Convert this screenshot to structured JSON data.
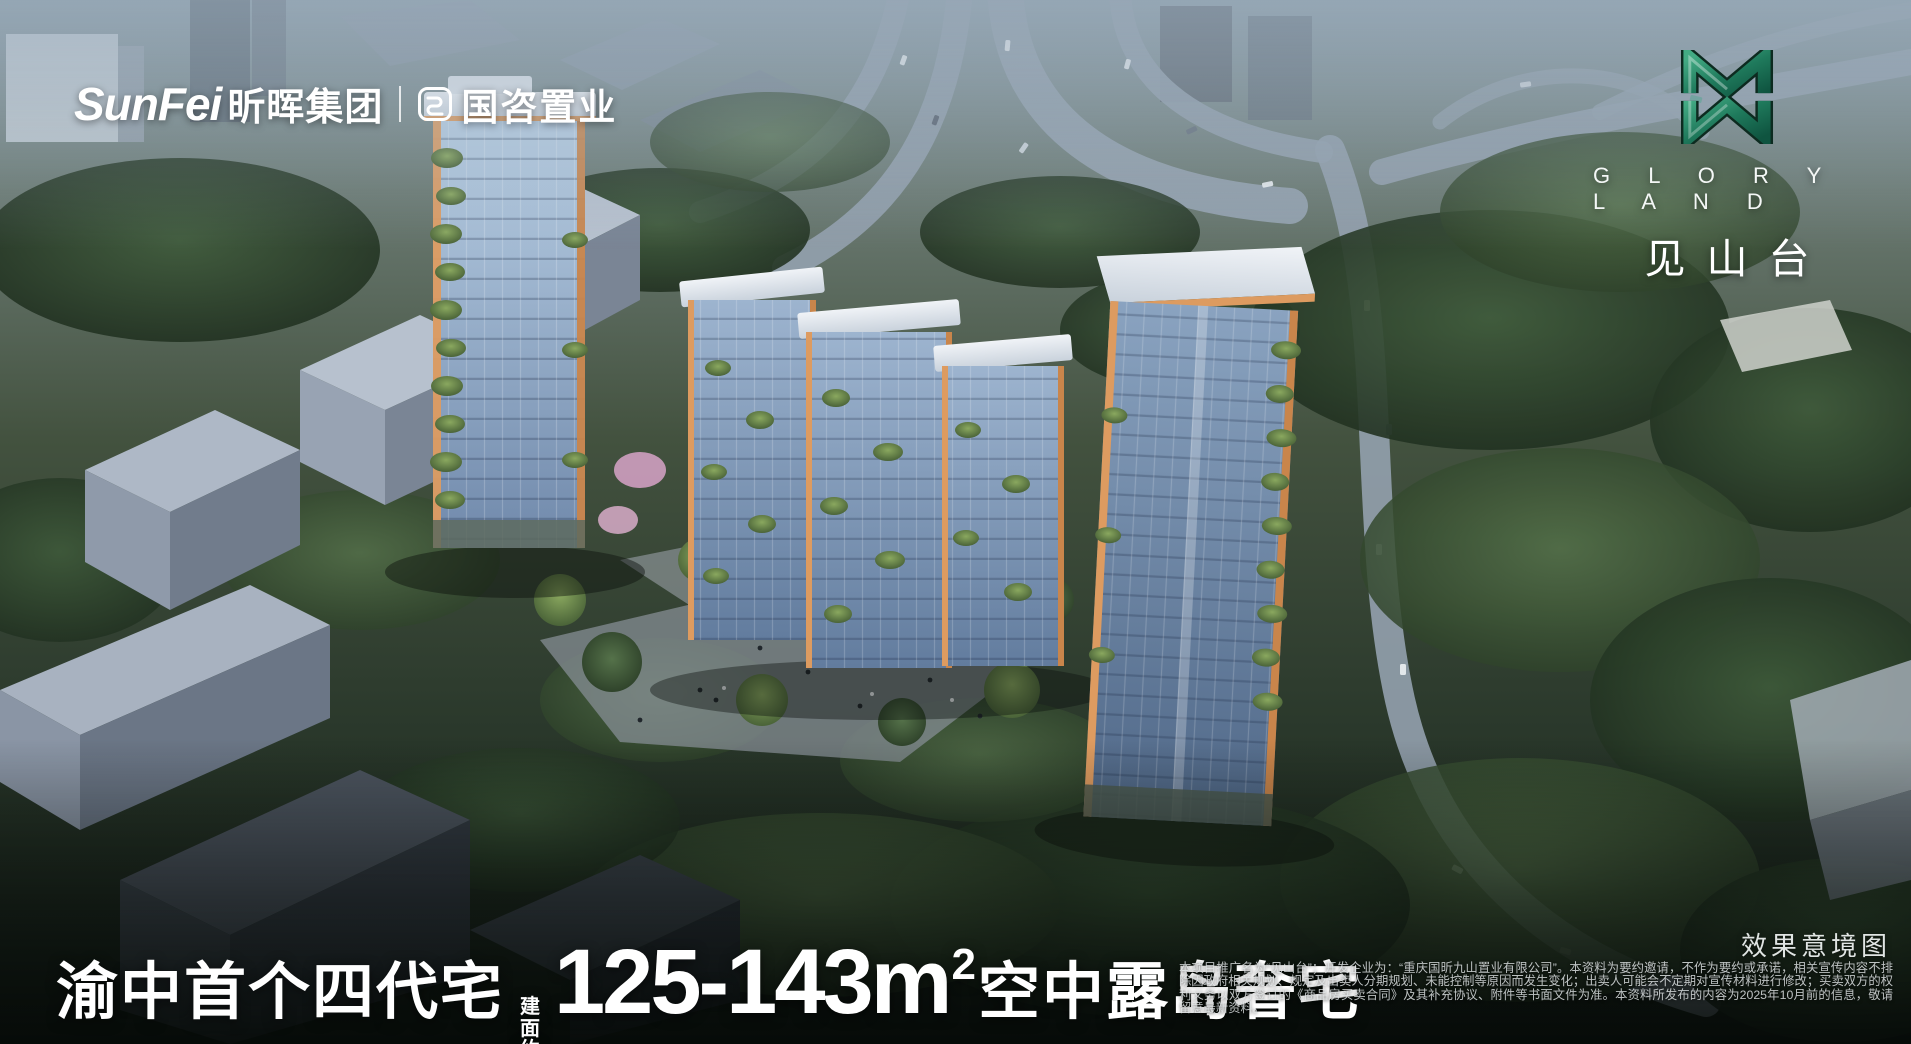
{
  "brand": {
    "name_en": "SunFei",
    "name_cn": "昕晖集团",
    "partner": "国咨置业"
  },
  "project": {
    "name_en": "G L O R Y  L A N D",
    "name_cn": "见山台",
    "emblem_green": "#2e8f6e",
    "accent_orange": "#dd9b60"
  },
  "headline": {
    "prefix": "渝中首个四代宅",
    "area_label": "建面约",
    "area_value": "125-143m",
    "area_sup": "2",
    "suffix": "空中露岛奢宅"
  },
  "footer": {
    "render_label": "效果意境图",
    "disclaimer": "本项目推广名为“见山台”；开发企业为：“重庆国昕九山置业有限公司”。本资料为要约邀请，不作为要约或承诺，相关宣传内容不排除因政府相关规划、规定及出卖人分期规划、未能控制等原因而发生变化；出卖人可能会不定期对宣传材料进行修改；买卖双方的权利义务以双方签订的《商品房买卖合同》及其补充协议、附件等书面文件为准。本资料所发布的内容为2025年10月前的信息，敬请留意最新资料。"
  },
  "icons": {
    "partner_logo": "guozi-rounded-square-icon",
    "emblem": "double-m-monogram-icon"
  }
}
